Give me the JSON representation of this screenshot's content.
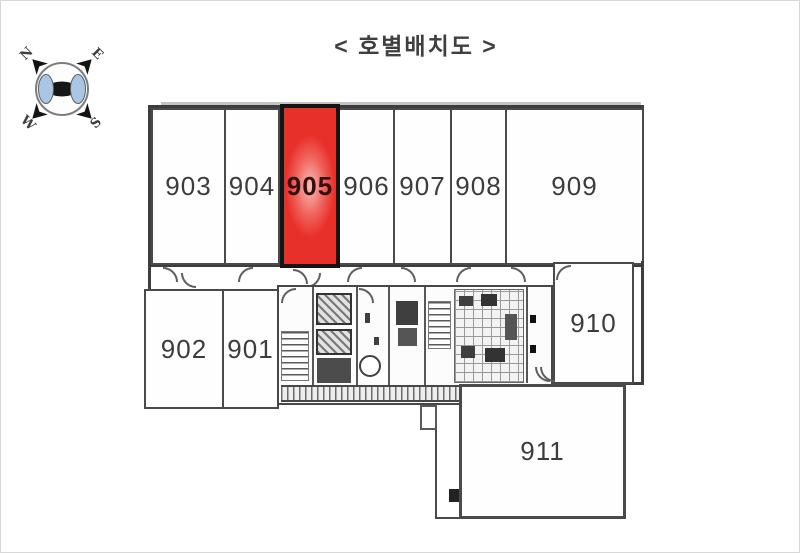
{
  "title": "< 호별배치도 >",
  "compass": {
    "north": "N",
    "east": "E",
    "south": "S",
    "west": "W",
    "blue": "#a9c6e4"
  },
  "units": [
    {
      "id": "903",
      "label": "903",
      "highlighted": false
    },
    {
      "id": "904",
      "label": "904",
      "highlighted": false
    },
    {
      "id": "905",
      "label": "905",
      "highlighted": true
    },
    {
      "id": "906",
      "label": "906",
      "highlighted": false
    },
    {
      "id": "907",
      "label": "907",
      "highlighted": false
    },
    {
      "id": "908",
      "label": "908",
      "highlighted": false
    },
    {
      "id": "909",
      "label": "909",
      "highlighted": false
    },
    {
      "id": "902",
      "label": "902",
      "highlighted": false
    },
    {
      "id": "901",
      "label": "901",
      "highlighted": false
    },
    {
      "id": "910",
      "label": "910",
      "highlighted": false
    },
    {
      "id": "911",
      "label": "911",
      "highlighted": false
    }
  ],
  "colors": {
    "highlight": "#e8302a",
    "highlight_mid": "#f0625b",
    "highlight_center": "#f9bdb8",
    "wall": "#4a4a4a",
    "compass_blue": "#a9c6e4"
  }
}
